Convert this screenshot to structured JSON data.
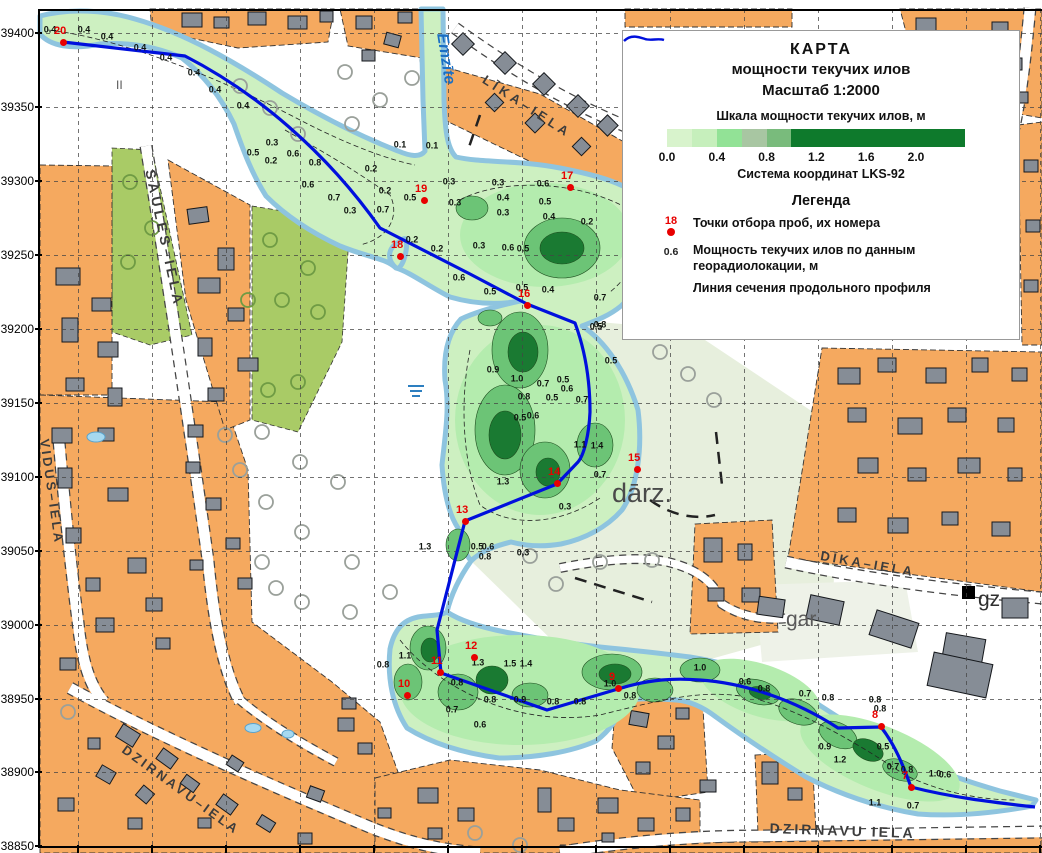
{
  "colors": {
    "orange_block": "#f5a95f",
    "building_gray": "#868d96",
    "olive_green": "#a9cb66",
    "pale_green": "#e7efdd",
    "silt_base": "#cdf0c1",
    "silt_medium": "#b4ecae",
    "silt_dark": "#6cc476",
    "silt_darkest": "#1a7a32",
    "water_edge": "#8ec4df",
    "profile_line": "#0010dd",
    "sample_point": "#e80000"
  },
  "legend": {
    "title_line1": "КАРТА",
    "title_line2": "мощности текучих  илов",
    "title_line3": "Масштаб 1:2000",
    "scale_title": "Шкала  мощности текучих илов, м",
    "scale_cells": [
      {
        "c": "#d8f3cc",
        "w": 25
      },
      {
        "c": "#c6efbc",
        "w": 25
      },
      {
        "c": "#92e296",
        "w": 25
      },
      {
        "c": "#a8c6a2",
        "w": 25
      },
      {
        "c": "#79bb7c",
        "w": 24
      },
      {
        "c": "#0e7a2c",
        "w": 174
      }
    ],
    "scale_ticks": [
      "0.0",
      "0.4",
      "0.8",
      "1.2",
      "1.6",
      "2.0"
    ],
    "coord_system": "Система координат LKS-92",
    "legend_heading": "Легенда",
    "sample_point_example_number": "18",
    "sample_points_label": "Точки отбора проб, их номера",
    "depth_example_value": "0.6",
    "depth_label_line1": "Мощность текучих илов по данным",
    "depth_label_line2": "георадиолокации, м",
    "profile_line_label": "Линия сечения продольного профиля"
  },
  "axis": {
    "y_labels": [
      {
        "t": "39400",
        "y": 33
      },
      {
        "t": "39350",
        "y": 107
      },
      {
        "t": "39300",
        "y": 181
      },
      {
        "t": "39250",
        "y": 255
      },
      {
        "t": "39200",
        "y": 329
      },
      {
        "t": "39150",
        "y": 403
      },
      {
        "t": "39100",
        "y": 477
      },
      {
        "t": "39050",
        "y": 551
      },
      {
        "t": "39000",
        "y": 625
      },
      {
        "t": "38950",
        "y": 699
      },
      {
        "t": "38900",
        "y": 772
      },
      {
        "t": "38850",
        "y": 846
      }
    ],
    "x_ticks": [
      78,
      152,
      226,
      300,
      374,
      448,
      522,
      596,
      670,
      744,
      818,
      892,
      966,
      1040
    ]
  },
  "street_labels": [
    {
      "t": "SAULES–IELA",
      "x": 158,
      "y": 168,
      "r": 78,
      "s": 14,
      "ls": 4
    },
    {
      "t": "VIDUS–IELA",
      "x": 52,
      "y": 438,
      "r": 82,
      "s": 13,
      "ls": 3
    },
    {
      "t": "LĪKA–IELA",
      "x": 488,
      "y": 72,
      "r": 33,
      "s": 13,
      "ls": 4
    },
    {
      "t": "DĪKA–IELA",
      "x": 822,
      "y": 548,
      "r": 10,
      "s": 13,
      "ls": 3
    },
    {
      "t": "DZIRNAVU–IELA",
      "x": 128,
      "y": 742,
      "r": 36,
      "s": 13,
      "ls": 3
    },
    {
      "t": "DZIRNAVU IELA",
      "x": 770,
      "y": 820,
      "r": 2,
      "s": 14,
      "ls": 3
    },
    {
      "t": "IELA",
      "x": 1012,
      "y": 36,
      "r": 76,
      "s": 13,
      "ls": 3
    }
  ],
  "place_labels": [
    {
      "t": "Emzīte",
      "x": 450,
      "y": 32,
      "r": 81,
      "s": 16,
      "c": "#1a6fc4",
      "i": 1,
      "b": 1
    },
    {
      "t": "dārz.",
      "x": 612,
      "y": 478,
      "r": 0,
      "s": 27,
      "c": "#4a4a4a",
      "i": 0,
      "b": 0
    },
    {
      "t": "gar.",
      "x": 786,
      "y": 608,
      "r": 0,
      "s": 21,
      "c": "#5a5a5a",
      "i": 0,
      "b": 0
    },
    {
      "t": "gz",
      "x": 978,
      "y": 588,
      "r": 0,
      "s": 21,
      "c": "#2f2f2f",
      "i": 0,
      "b": 0
    },
    {
      "t": "II",
      "x": 116,
      "y": 78,
      "r": 0,
      "s": 12,
      "c": "#555555",
      "i": 0,
      "b": 0
    }
  ],
  "sample_points": [
    {
      "n": "7",
      "x": 911,
      "y": 787
    },
    {
      "n": "8",
      "x": 881,
      "y": 726
    },
    {
      "n": "9",
      "x": 618,
      "y": 688
    },
    {
      "n": "10",
      "x": 407,
      "y": 695
    },
    {
      "n": "11",
      "x": 440,
      "y": 672
    },
    {
      "n": "12",
      "x": 474,
      "y": 657
    },
    {
      "n": "13",
      "x": 465,
      "y": 521
    },
    {
      "n": "14",
      "x": 557,
      "y": 483
    },
    {
      "n": "15",
      "x": 637,
      "y": 469
    },
    {
      "n": "16",
      "x": 527,
      "y": 305
    },
    {
      "n": "17",
      "x": 570,
      "y": 187
    },
    {
      "n": "18",
      "x": 400,
      "y": 256
    },
    {
      "n": "19",
      "x": 424,
      "y": 200
    },
    {
      "n": "20",
      "x": 63,
      "y": 42
    }
  ],
  "depth_values": [
    {
      "v": "0.4",
      "x": 50,
      "y": 30
    },
    {
      "v": "0.4",
      "x": 84,
      "y": 30
    },
    {
      "v": "0.4",
      "x": 107,
      "y": 37
    },
    {
      "v": "0.4",
      "x": 140,
      "y": 48
    },
    {
      "v": "0.4",
      "x": 166,
      "y": 58
    },
    {
      "v": "0.4",
      "x": 194,
      "y": 73
    },
    {
      "v": "0.4",
      "x": 215,
      "y": 90
    },
    {
      "v": "0.4",
      "x": 243,
      "y": 106
    },
    {
      "v": "0.3",
      "x": 272,
      "y": 143
    },
    {
      "v": "0.5",
      "x": 253,
      "y": 153
    },
    {
      "v": "0.2",
      "x": 271,
      "y": 161
    },
    {
      "v": "0.6",
      "x": 293,
      "y": 154
    },
    {
      "v": "0.8",
      "x": 315,
      "y": 163
    },
    {
      "v": "0.1",
      "x": 400,
      "y": 145
    },
    {
      "v": "0.1",
      "x": 432,
      "y": 146
    },
    {
      "v": "0.2",
      "x": 371,
      "y": 169
    },
    {
      "v": "0.6",
      "x": 308,
      "y": 185
    },
    {
      "v": "0.7",
      "x": 334,
      "y": 198
    },
    {
      "v": "0.3",
      "x": 350,
      "y": 211
    },
    {
      "v": "0.2",
      "x": 385,
      "y": 191
    },
    {
      "v": "0.7",
      "x": 383,
      "y": 210
    },
    {
      "v": "0.5",
      "x": 410,
      "y": 198
    },
    {
      "v": "0.2",
      "x": 412,
      "y": 240
    },
    {
      "v": "0.2",
      "x": 437,
      "y": 249
    },
    {
      "v": "0.3",
      "x": 449,
      "y": 182
    },
    {
      "v": "0.3",
      "x": 498,
      "y": 183
    },
    {
      "v": "0.6",
      "x": 543,
      "y": 184
    },
    {
      "v": "0.3",
      "x": 455,
      "y": 203
    },
    {
      "v": "0.4",
      "x": 503,
      "y": 198
    },
    {
      "v": "0.3",
      "x": 503,
      "y": 213
    },
    {
      "v": "0.5",
      "x": 545,
      "y": 202
    },
    {
      "v": "0.4",
      "x": 549,
      "y": 217
    },
    {
      "v": "0.2",
      "x": 587,
      "y": 222
    },
    {
      "v": "0.3",
      "x": 479,
      "y": 246
    },
    {
      "v": "0.6",
      "x": 508,
      "y": 248
    },
    {
      "v": "0.5",
      "x": 523,
      "y": 249
    },
    {
      "v": "0.6",
      "x": 459,
      "y": 278
    },
    {
      "v": "0.5",
      "x": 522,
      "y": 288
    },
    {
      "v": "0.4",
      "x": 548,
      "y": 290
    },
    {
      "v": "0.7",
      "x": 600,
      "y": 298
    },
    {
      "v": "0.8",
      "x": 600,
      "y": 325
    },
    {
      "v": "0.5",
      "x": 490,
      "y": 292
    },
    {
      "v": "0.9",
      "x": 493,
      "y": 370
    },
    {
      "v": "1.0",
      "x": 517,
      "y": 379
    },
    {
      "v": "0.7",
      "x": 543,
      "y": 384
    },
    {
      "v": "0.5",
      "x": 563,
      "y": 380
    },
    {
      "v": "0.6",
      "x": 567,
      "y": 389
    },
    {
      "v": "0.8",
      "x": 524,
      "y": 397
    },
    {
      "v": "0.5",
      "x": 552,
      "y": 398
    },
    {
      "v": "0.7",
      "x": 582,
      "y": 400
    },
    {
      "v": "0.5",
      "x": 596,
      "y": 327
    },
    {
      "v": "0.5",
      "x": 611,
      "y": 361
    },
    {
      "v": "0.6",
      "x": 533,
      "y": 416
    },
    {
      "v": "0.5",
      "x": 520,
      "y": 418
    },
    {
      "v": "1.1",
      "x": 580,
      "y": 445
    },
    {
      "v": "1.4",
      "x": 597,
      "y": 446
    },
    {
      "v": "0.7",
      "x": 600,
      "y": 475
    },
    {
      "v": "1.3",
      "x": 503,
      "y": 482
    },
    {
      "v": "0.3",
      "x": 565,
      "y": 507
    },
    {
      "v": "0.5",
      "x": 477,
      "y": 547
    },
    {
      "v": "0.6",
      "x": 488,
      "y": 547
    },
    {
      "v": "0.3",
      "x": 523,
      "y": 553
    },
    {
      "v": "1.3",
      "x": 425,
      "y": 547
    },
    {
      "v": "0.8",
      "x": 485,
      "y": 557
    },
    {
      "v": "1.1",
      "x": 405,
      "y": 656
    },
    {
      "v": "0.8",
      "x": 383,
      "y": 665
    },
    {
      "v": "1.3",
      "x": 478,
      "y": 663
    },
    {
      "v": "1.5",
      "x": 510,
      "y": 664
    },
    {
      "v": "1.4",
      "x": 526,
      "y": 664
    },
    {
      "v": "0.8",
      "x": 457,
      "y": 683
    },
    {
      "v": "0.8",
      "x": 490,
      "y": 700
    },
    {
      "v": "0.9",
      "x": 520,
      "y": 700
    },
    {
      "v": "0.8",
      "x": 553,
      "y": 702
    },
    {
      "v": "0.8",
      "x": 580,
      "y": 702
    },
    {
      "v": "0.7",
      "x": 452,
      "y": 710
    },
    {
      "v": "0.6",
      "x": 480,
      "y": 725
    },
    {
      "v": "1.0",
      "x": 610,
      "y": 684
    },
    {
      "v": "0.8",
      "x": 630,
      "y": 696
    },
    {
      "v": "1.0",
      "x": 700,
      "y": 668
    },
    {
      "v": "0.6",
      "x": 745,
      "y": 682
    },
    {
      "v": "0.8",
      "x": 764,
      "y": 689
    },
    {
      "v": "0.7",
      "x": 805,
      "y": 694
    },
    {
      "v": "0.8",
      "x": 828,
      "y": 698
    },
    {
      "v": "0.8",
      "x": 875,
      "y": 700
    },
    {
      "v": "0.8",
      "x": 880,
      "y": 709
    },
    {
      "v": "0.9",
      "x": 825,
      "y": 747
    },
    {
      "v": "1.2",
      "x": 840,
      "y": 760
    },
    {
      "v": "0.5",
      "x": 883,
      "y": 747
    },
    {
      "v": "0.7",
      "x": 893,
      "y": 767
    },
    {
      "v": "0.8",
      "x": 907,
      "y": 770
    },
    {
      "v": "1.0",
      "x": 935,
      "y": 774
    },
    {
      "v": "0.6",
      "x": 945,
      "y": 775
    },
    {
      "v": "1.1",
      "x": 875,
      "y": 803
    },
    {
      "v": "0.7",
      "x": 913,
      "y": 806
    }
  ]
}
